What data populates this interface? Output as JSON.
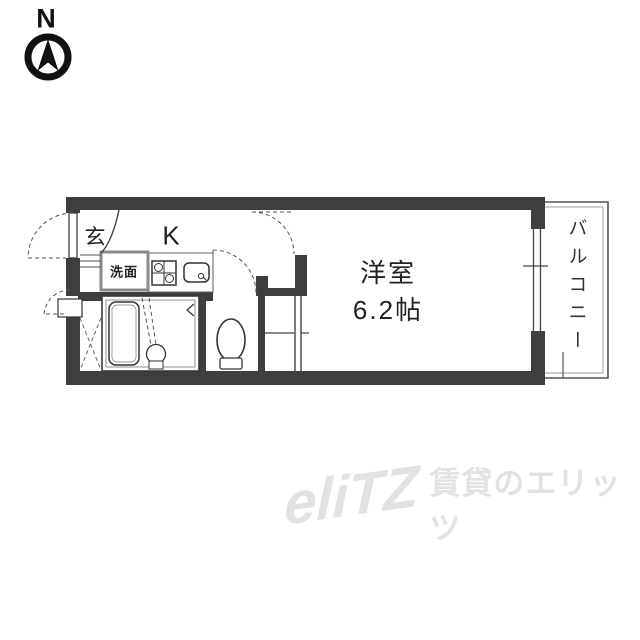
{
  "compass": {
    "label": "N",
    "icon": "north-arrow-icon"
  },
  "plan": {
    "entrance_label": "玄",
    "kitchen_label": "K",
    "washbasin_label": "洗面",
    "main_room": {
      "name": "洋室",
      "size": "6.2帖"
    },
    "balcony_label": "バルコニー",
    "icons": [
      "bathtub-icon",
      "toilet-icon",
      "wash-basin-icon",
      "gas-stove-icon",
      "kitchen-sink-icon",
      "door-swing-arc",
      "entrance-step-lines",
      "storage-x-mark",
      "window-lines"
    ]
  },
  "watermark": {
    "logo": "eliTZ",
    "text": "賃貸のエリッツ"
  },
  "colors": {
    "wall": "#3e3e3e",
    "line": "#3a3a3a",
    "light_line": "#8a8a8a",
    "watermark": "#e2e2e2",
    "text": "#222222"
  }
}
